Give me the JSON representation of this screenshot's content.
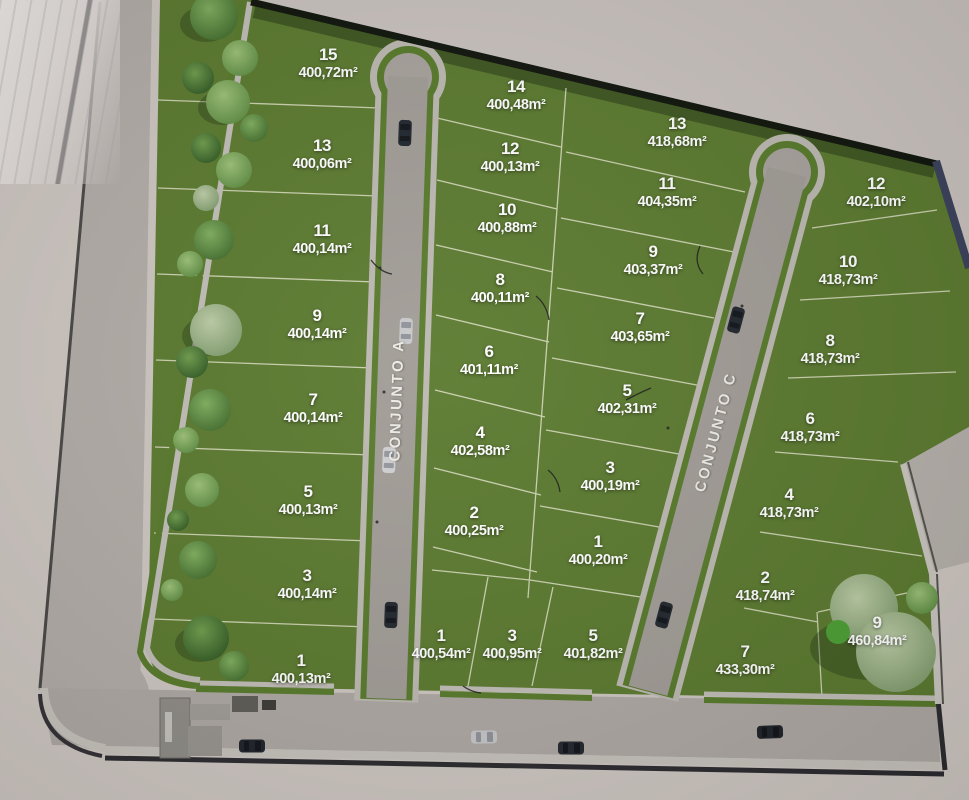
{
  "roads": {
    "a": {
      "label": "CONJUNTO A"
    },
    "c": {
      "label": "CONJUNTO C"
    }
  },
  "lots": {
    "west_column": [
      {
        "number": "15",
        "area": "400,72m²"
      },
      {
        "number": "13",
        "area": "400,06m²"
      },
      {
        "number": "11",
        "area": "400,14m²"
      },
      {
        "number": "9",
        "area": "400,14m²"
      },
      {
        "number": "7",
        "area": "400,14m²"
      },
      {
        "number": "5",
        "area": "400,13m²"
      },
      {
        "number": "3",
        "area": "400,14m²"
      },
      {
        "number": "1",
        "area": "400,13m²"
      }
    ],
    "center_west": [
      {
        "number": "14",
        "area": "400,48m²"
      },
      {
        "number": "12",
        "area": "400,13m²"
      },
      {
        "number": "10",
        "area": "400,88m²"
      },
      {
        "number": "8",
        "area": "400,11m²"
      },
      {
        "number": "6",
        "area": "401,11m²"
      },
      {
        "number": "4",
        "area": "402,58m²"
      },
      {
        "number": "2",
        "area": "400,25m²"
      }
    ],
    "center_bottom": [
      {
        "number": "1",
        "area": "400,54m²"
      },
      {
        "number": "3",
        "area": "400,95m²"
      },
      {
        "number": "5",
        "area": "401,82m²"
      }
    ],
    "center_east": [
      {
        "number": "13",
        "area": "418,68m²"
      },
      {
        "number": "11",
        "area": "404,35m²"
      },
      {
        "number": "9",
        "area": "403,37m²"
      },
      {
        "number": "7",
        "area": "403,65m²"
      },
      {
        "number": "5",
        "area": "402,31m²"
      },
      {
        "number": "3",
        "area": "400,19m²"
      },
      {
        "number": "1",
        "area": "400,20m²"
      }
    ],
    "east_column": [
      {
        "number": "12",
        "area": "402,10m²"
      },
      {
        "number": "10",
        "area": "418,73m²"
      },
      {
        "number": "8",
        "area": "418,73m²"
      },
      {
        "number": "6",
        "area": "418,73m²"
      },
      {
        "number": "4",
        "area": "418,73m²"
      },
      {
        "number": "2",
        "area": "418,74m²"
      },
      {
        "number": "7",
        "area": "433,30m²"
      },
      {
        "number": "9",
        "area": "460,84m²"
      }
    ]
  },
  "colors": {
    "grass": "#5b7a2f",
    "road": "#a19c96",
    "sidewalk": "#c1bdb7",
    "verge": "#587a2b",
    "outside_ground": "#cdc6c1",
    "boundary_wall_dark": "#10150c",
    "boundary_wall_navy": "#39415a",
    "lot_line": "#efeeda",
    "label_text": "#ffffff"
  }
}
